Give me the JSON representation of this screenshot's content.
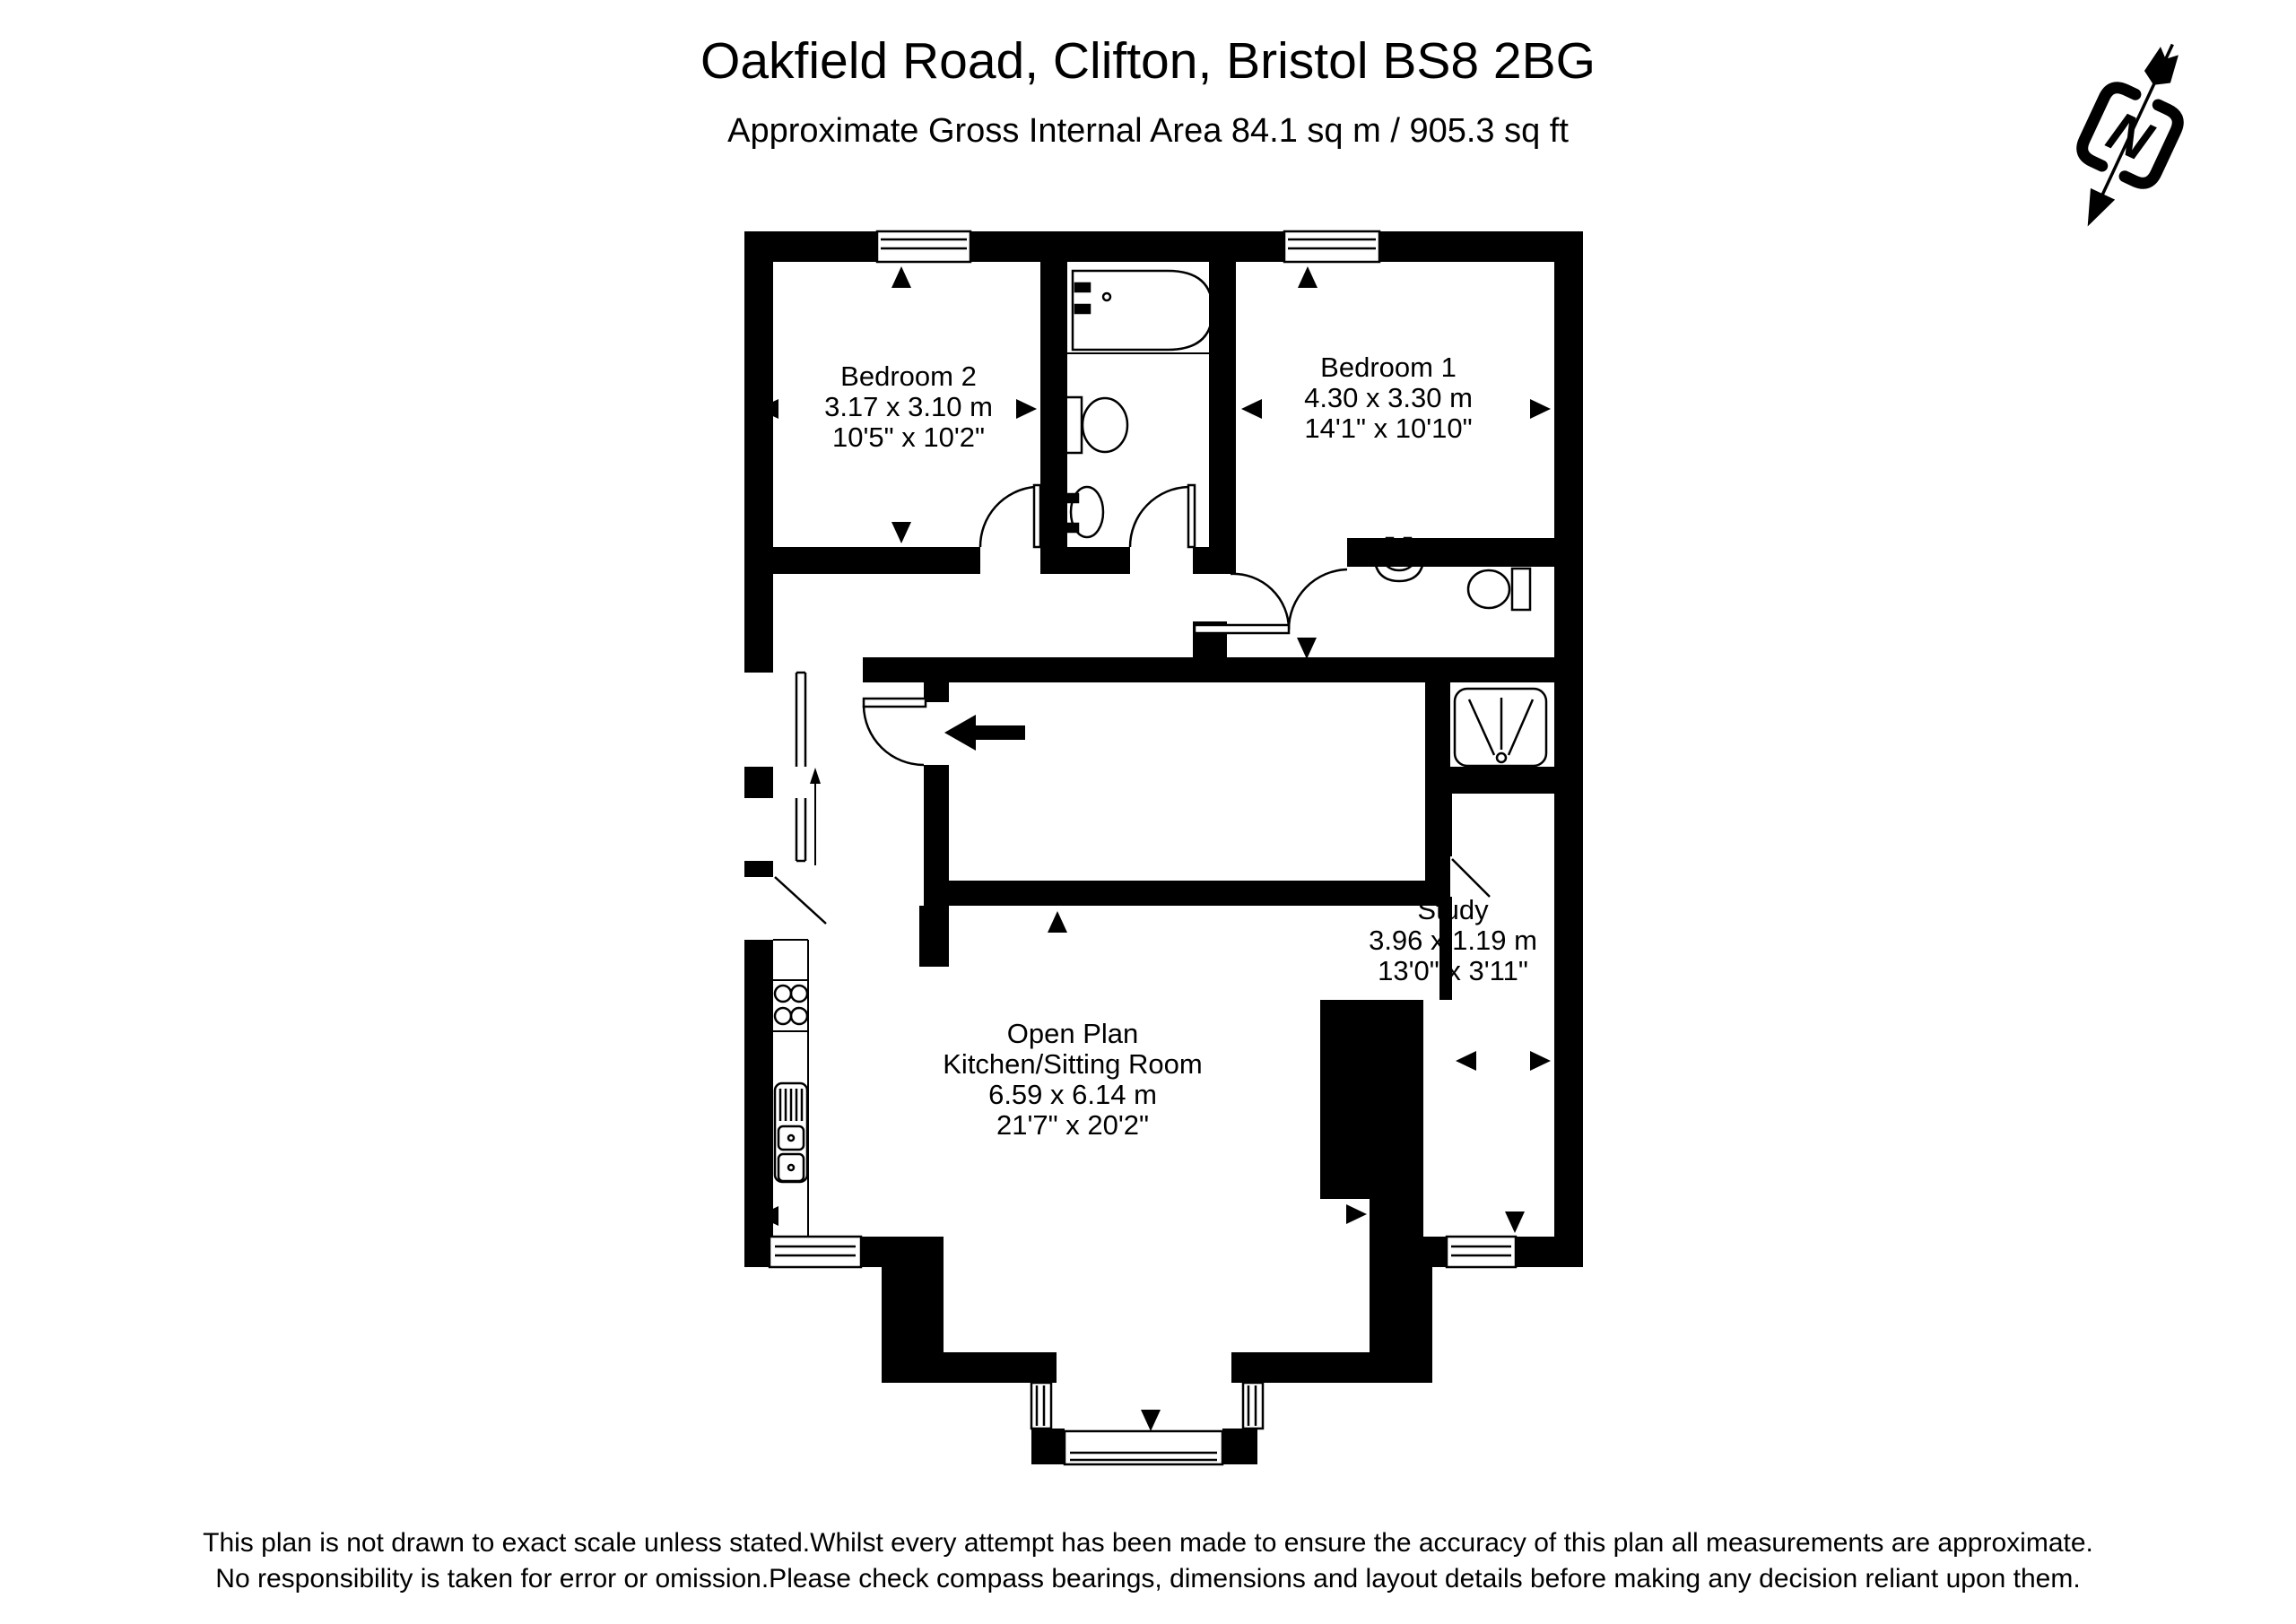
{
  "header": {
    "title": "Oakfield Road, Clifton, Bristol BS8 2BG",
    "subtitle": "Approximate Gross Internal Area 84.1 sq m / 905.3 sq ft"
  },
  "compass": {
    "label": "N"
  },
  "rooms": [
    {
      "name": "Bedroom 2",
      "metric": "3.17 x 3.10 m",
      "imperial": "10'5\" x 10'2\""
    },
    {
      "name": "Bedroom 1",
      "metric": "4.30 x 3.30 m",
      "imperial": "14'1\" x 10'10\""
    },
    {
      "name": "Study",
      "metric": "3.96 x 1.19 m",
      "imperial": "13'0\" x 3'11\""
    },
    {
      "name": "Open Plan",
      "name2": "Kitchen/Sitting Room",
      "metric": "6.59 x 6.14 m",
      "imperial": "21'7\" x 20'2\""
    }
  ],
  "footer": {
    "line1": "This plan is not drawn to exact scale unless stated.Whilst every attempt has been made to ensure the accuracy of this plan all measurements are approximate.",
    "line2": "No responsibility is taken for error or omission.Please check compass bearings, dimensions and layout details before making any decision reliant upon them."
  },
  "colors": {
    "ink": "#000000",
    "background": "#ffffff"
  }
}
